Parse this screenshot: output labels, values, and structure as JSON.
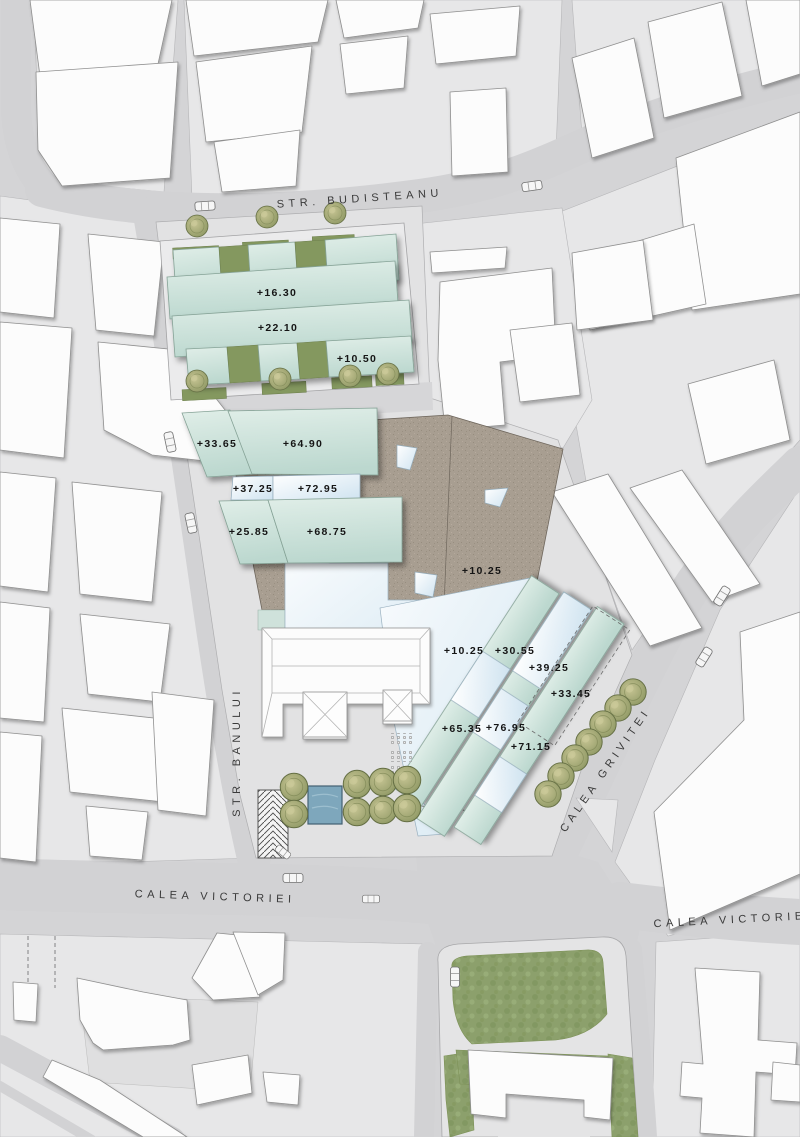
{
  "title": "Urban site plan",
  "streets": [
    {
      "id": "budisteanu",
      "name": "STR. BUDISTEANU"
    },
    {
      "id": "banului",
      "name": "STR. BANULUI"
    },
    {
      "id": "victoriei-west",
      "name": "CALEA VICTORIEI"
    },
    {
      "id": "victoriei-east",
      "name": "CALEA VICTORIEI"
    },
    {
      "id": "grivitei",
      "name": "CALEA GRIVITEI"
    }
  ],
  "elevations": [
    {
      "value": "+16.30"
    },
    {
      "value": "+22.10"
    },
    {
      "value": "+10.50"
    },
    {
      "value": "+33.65"
    },
    {
      "value": "+64.90"
    },
    {
      "value": "+37.25"
    },
    {
      "value": "+72.95"
    },
    {
      "value": "+25.85"
    },
    {
      "value": "+68.75"
    },
    {
      "value": "+10.25"
    },
    {
      "value": "+10.25"
    },
    {
      "value": "+30.55"
    },
    {
      "value": "+39.25"
    },
    {
      "value": "+33.45"
    },
    {
      "value": "+65.35"
    },
    {
      "value": "+76.95"
    },
    {
      "value": "+71.15"
    }
  ],
  "colors": {
    "street": "#d2d2d4",
    "parcel": "#e7e7e8",
    "building_white": "#fcfcfc",
    "proposed_teal": "#c5ddd4",
    "glass_blue": "#d4e6f2",
    "plaza_brown": "#a89e91",
    "lawn_green": "#8ca06c",
    "tree_olive": "#99a36e",
    "pool_blue": "#7ea7bc"
  }
}
